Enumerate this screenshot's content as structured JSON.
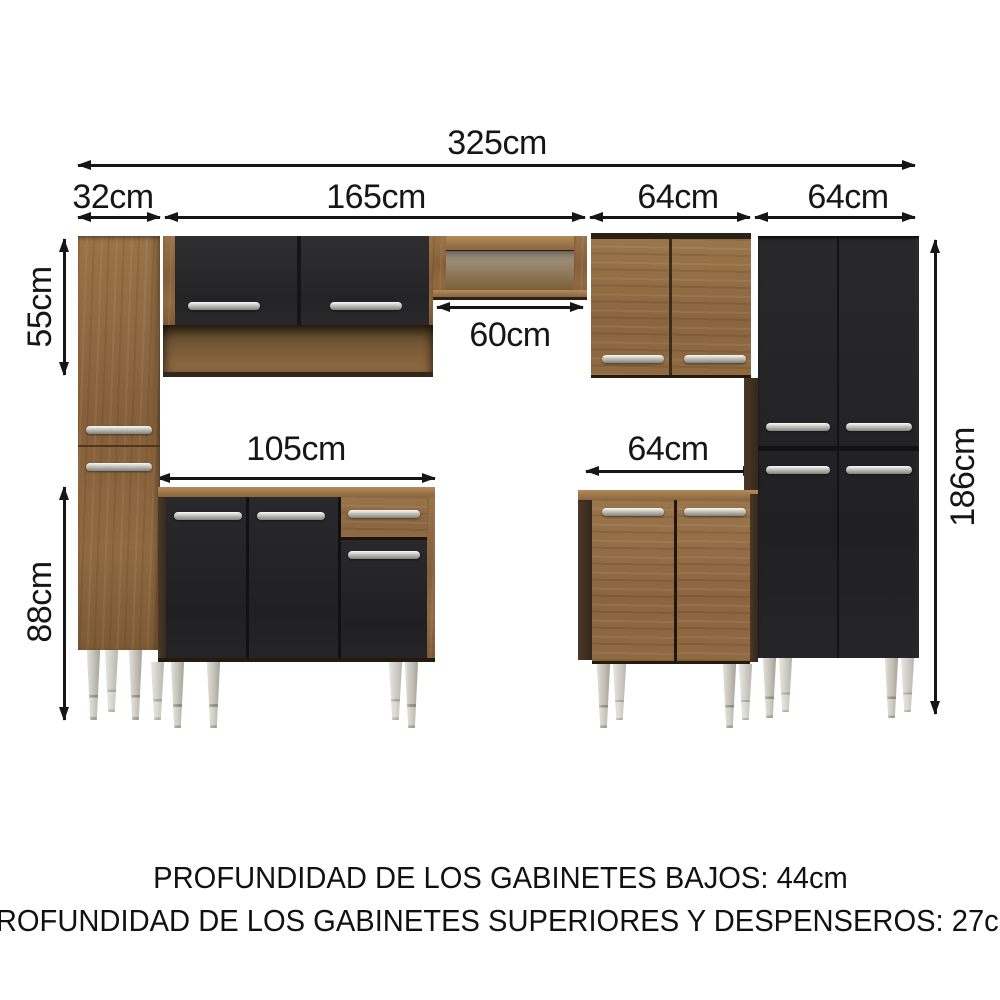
{
  "diagram": {
    "subject": "kitchen-cabinet-set-dimensions",
    "dims": {
      "total": "325cm",
      "sections": [
        "32cm",
        "165cm",
        "64cm",
        "64cm"
      ],
      "upper_height": "55cm",
      "base_height": "88cm",
      "total_height": "186cm",
      "niche_width": "60cm",
      "center_base": "105cm",
      "right_base": "64cm"
    },
    "footer": {
      "line1": "PROFUNDIDAD DE LOS GABINETES BAJOS: 44cm",
      "line2": "PROFUNDIDAD DE LOS GABINETES SUPERIORES Y DESPENSEROS: 27cm"
    },
    "colors": {
      "wood": "#8d6a41",
      "door_black": "#28282a",
      "handle_silver": "#c9c9c4",
      "leg_silver": "#b9b6ac",
      "dimension_lines": "#161616",
      "background": "#ffffff"
    }
  }
}
